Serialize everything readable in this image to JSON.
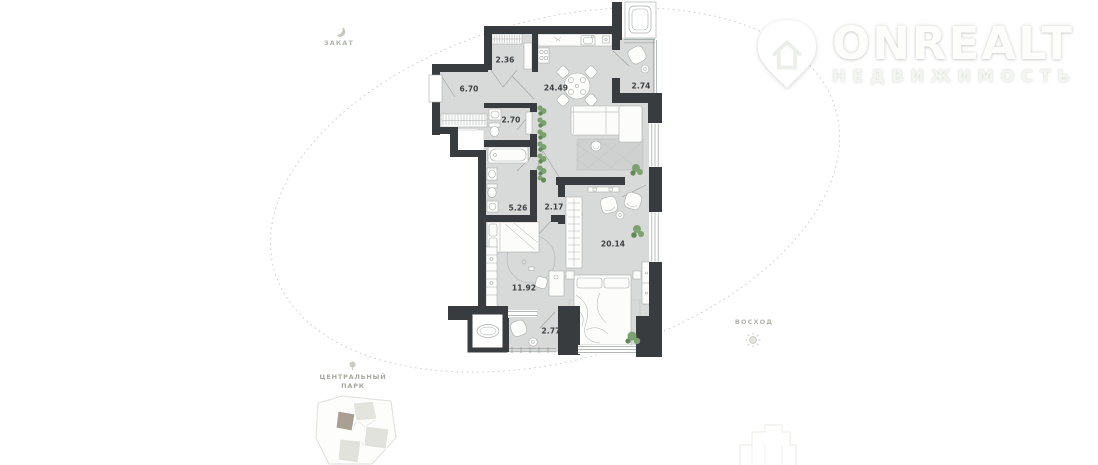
{
  "watermark": {
    "brand": "ONREALT",
    "subtitle": "НЕДВИЖИМОСТЬ"
  },
  "orientation": {
    "sunset": "ЗАКАТ",
    "sunrise": "ВОСХОД"
  },
  "landmark": {
    "line1": "ЦЕНТРАЛЬНЫЙ",
    "line2": "ПАРК"
  },
  "floor_plan": {
    "rooms": [
      {
        "id": "wardrobe",
        "area": "2.36"
      },
      {
        "id": "hallway",
        "area": "6.70"
      },
      {
        "id": "kitchen-living",
        "area": "24.49"
      },
      {
        "id": "loggia-upper",
        "area": "2.74"
      },
      {
        "id": "wc",
        "area": "2.70"
      },
      {
        "id": "bathroom",
        "area": "5.26"
      },
      {
        "id": "corridor",
        "area": "2.17"
      },
      {
        "id": "bedroom-master",
        "area": "20.14"
      },
      {
        "id": "bedroom-second",
        "area": "11.92"
      },
      {
        "id": "loggia-lower",
        "area": "2.77"
      }
    ],
    "colors": {
      "wall": "#383c3e",
      "floor": "#d8dad9",
      "plant": "#7da26f",
      "highlight_building": "#a9a093"
    }
  }
}
